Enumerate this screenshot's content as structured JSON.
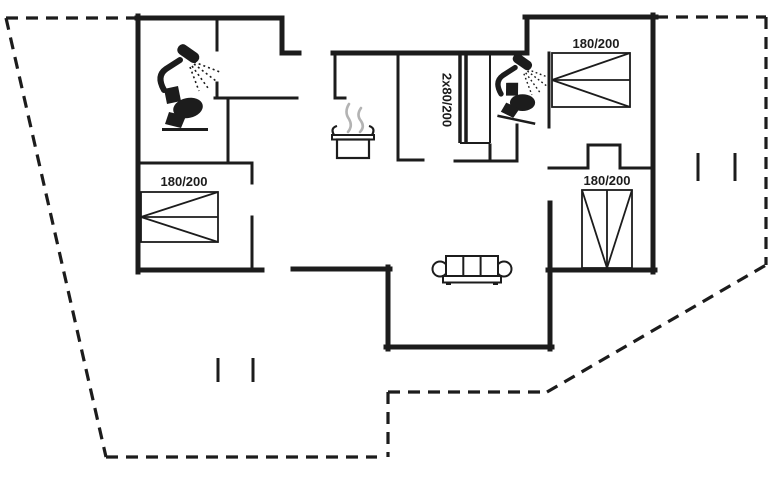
{
  "canvas": {
    "width": 768,
    "height": 480,
    "background": "#ffffff",
    "line_color": "#1c1c1c",
    "steam_color": "#b3b3b3"
  },
  "plan": {
    "exterior_walls": [
      [
        137,
        18,
        282,
        18
      ],
      [
        282,
        18,
        282,
        53
      ],
      [
        282,
        53,
        299,
        53
      ],
      [
        333,
        53,
        527,
        53
      ],
      [
        527,
        17,
        527,
        53
      ],
      [
        525,
        17,
        656,
        17
      ],
      [
        653,
        15,
        653,
        272
      ],
      [
        548,
        270,
        655,
        270
      ],
      [
        550,
        203,
        550,
        349
      ],
      [
        386,
        347,
        552,
        347
      ],
      [
        388,
        267,
        388,
        349
      ],
      [
        293,
        269,
        390,
        269
      ],
      [
        138,
        270,
        262,
        270
      ],
      [
        138,
        16,
        138,
        272
      ]
    ],
    "interior_walls": [
      [
        217,
        18,
        217,
        50
      ],
      [
        217,
        83,
        217,
        98
      ],
      [
        215,
        98,
        297,
        98
      ],
      [
        228,
        98,
        228,
        163
      ],
      [
        138,
        163,
        252,
        163
      ],
      [
        252,
        163,
        252,
        183
      ],
      [
        252,
        217,
        252,
        268
      ],
      [
        335,
        53,
        335,
        98
      ],
      [
        335,
        98,
        345,
        98
      ],
      [
        398,
        53,
        398,
        160
      ],
      [
        398,
        160,
        423,
        160
      ],
      [
        455,
        161,
        517,
        161
      ],
      [
        517,
        125,
        517,
        161
      ],
      [
        490,
        145,
        490,
        161
      ],
      [
        549,
        53,
        549,
        127
      ],
      [
        549,
        168,
        588,
        168
      ],
      [
        588,
        145,
        588,
        168
      ],
      [
        588,
        145,
        620,
        145
      ],
      [
        620,
        145,
        620,
        168
      ],
      [
        620,
        168,
        653,
        168
      ]
    ],
    "wardrobe": {
      "door_lines": [
        [
          460,
          55,
          460,
          143
        ],
        [
          466,
          55,
          466,
          143
        ]
      ],
      "outline": [
        [
          490,
          55,
          490,
          143
        ],
        [
          460,
          143,
          490,
          143
        ]
      ],
      "label": {
        "text": "2x80/200",
        "x": 447,
        "y": 100,
        "rotate": 90
      }
    },
    "dashed_outline": [
      [
        6,
        18,
        137,
        18
      ],
      [
        6,
        18,
        106,
        457
      ],
      [
        106,
        457,
        377,
        457
      ],
      [
        388,
        392,
        388,
        457
      ],
      [
        388,
        392,
        547,
        392
      ],
      [
        547,
        392,
        766,
        265
      ],
      [
        766,
        17,
        766,
        265
      ],
      [
        656,
        17,
        766,
        17
      ]
    ],
    "window_marks": [
      [
        218,
        358,
        218,
        382
      ],
      [
        253,
        358,
        253,
        382
      ],
      [
        698,
        153,
        698,
        181
      ],
      [
        735,
        153,
        735,
        181
      ]
    ],
    "beds": [
      {
        "label": "180/200",
        "x": 141,
        "y": 192,
        "w": 77,
        "h": 50,
        "head": "left",
        "label_x": 184,
        "label_y": 186
      },
      {
        "label": "180/200",
        "x": 552,
        "y": 53,
        "w": 78,
        "h": 54,
        "head": "left",
        "label_x": 596,
        "label_y": 48
      },
      {
        "label": "180/200",
        "x": 582,
        "y": 190,
        "w": 50,
        "h": 78,
        "head": "bottom",
        "label_x": 607,
        "label_y": 185
      }
    ],
    "fixtures": [
      {
        "type": "shower",
        "name": "shower-icon",
        "x": 156,
        "y": 48,
        "scale": 1.0,
        "rotate": 0
      },
      {
        "type": "toilet",
        "name": "toilet-icon",
        "x": 162,
        "y": 86,
        "scale": 1.0,
        "rotate": 0
      },
      {
        "type": "shower",
        "name": "shower-icon",
        "x": 494,
        "y": 57,
        "scale": 0.88,
        "rotate": 0
      },
      {
        "type": "toilet",
        "name": "toilet-icon",
        "x": 505,
        "y": 80,
        "scale": 0.84,
        "rotate": 12
      },
      {
        "type": "pot",
        "name": "cooking-pot-icon",
        "x": 331,
        "y": 103,
        "scale": 1.0,
        "rotate": 0
      },
      {
        "type": "sofa",
        "name": "sofa-icon",
        "x": 432,
        "y": 252,
        "scale": 1.0,
        "rotate": 0
      }
    ]
  }
}
